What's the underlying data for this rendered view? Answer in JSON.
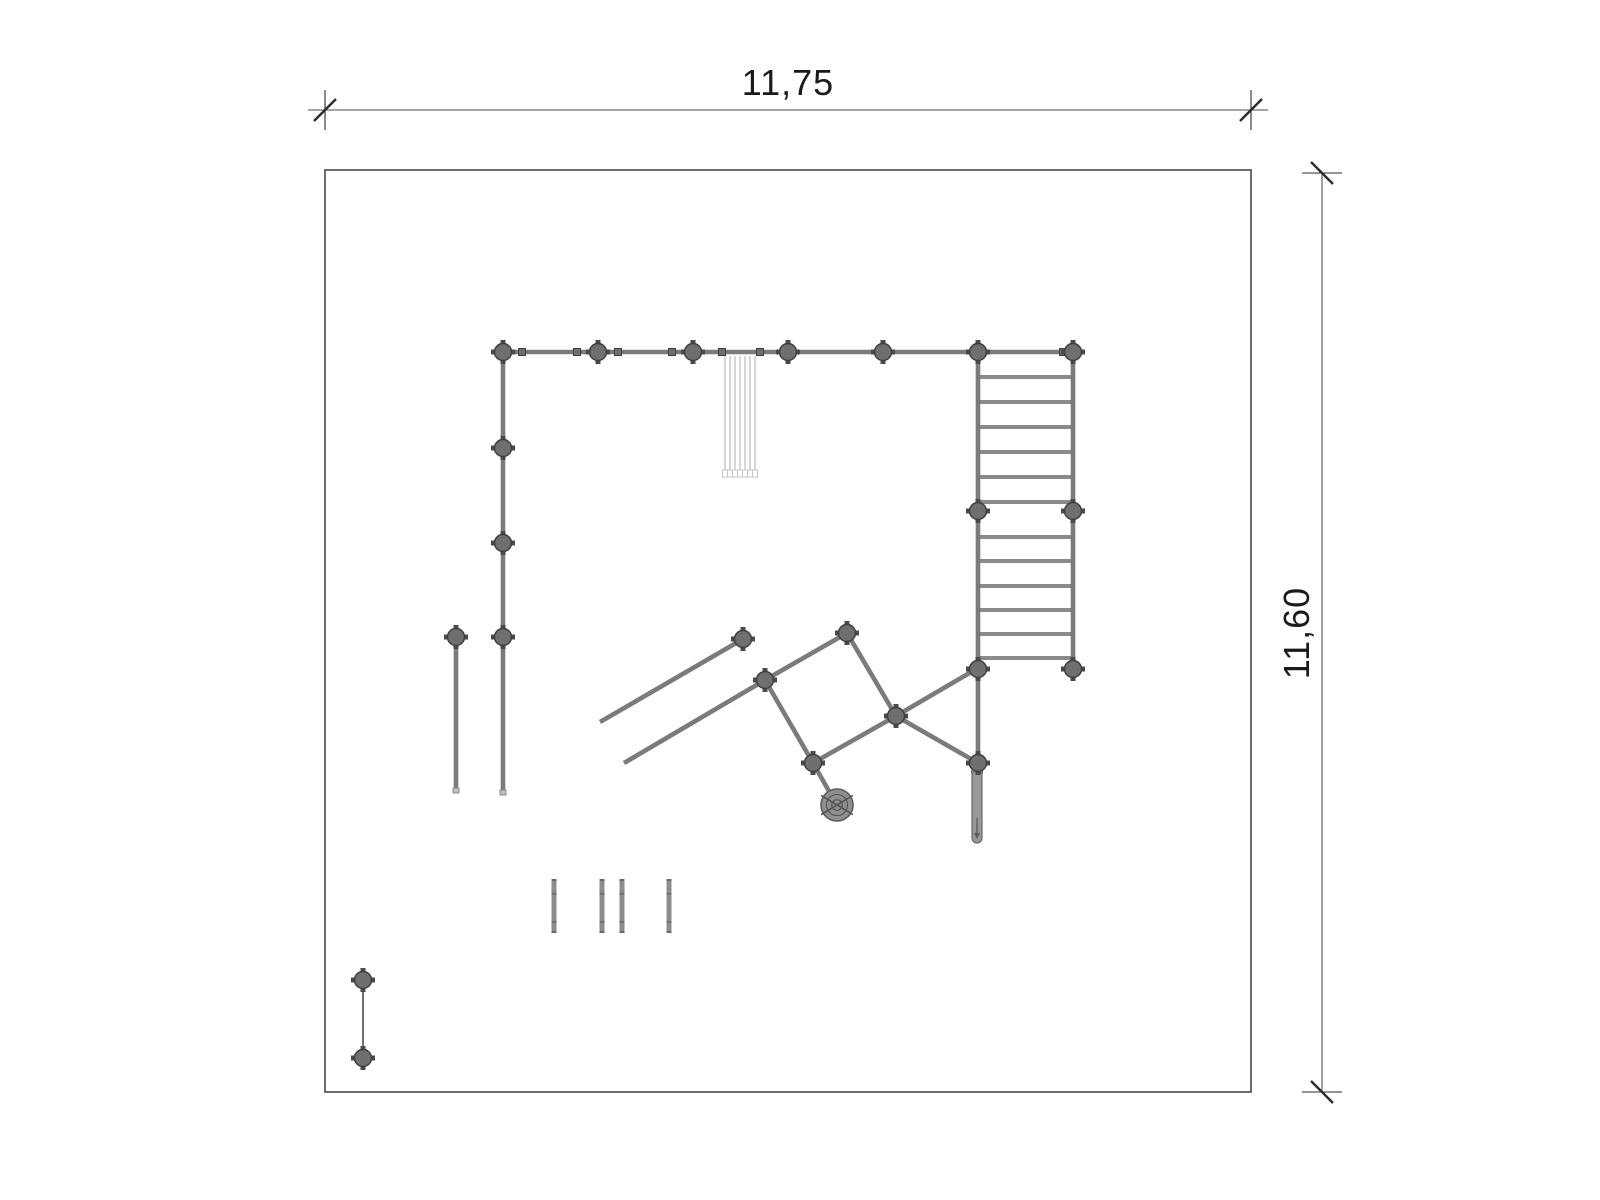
{
  "drawing": {
    "dim_top": {
      "label": "11,75",
      "line_y": 110,
      "x1": 308,
      "x2": 1268,
      "tick1": 325,
      "tick2": 1251,
      "label_cx": 788,
      "label_top": 62
    },
    "dim_right": {
      "label": "11,60",
      "line_x": 1322,
      "y1": 173,
      "y2": 1092,
      "label_cx": 1297,
      "label_cy": 633
    },
    "boundary": {
      "x": 325,
      "y": 170,
      "w": 926,
      "h": 922
    },
    "beams": [
      [
        503,
        352,
        1073,
        352
      ],
      [
        503,
        352,
        503,
        792
      ],
      [
        978,
        352,
        978,
        669
      ],
      [
        1073,
        352,
        1073,
        669
      ],
      [
        456,
        640,
        456,
        790
      ],
      [
        600,
        722,
        743,
        639
      ],
      [
        624,
        763,
        765,
        680
      ],
      [
        847,
        633,
        765,
        680
      ],
      [
        847,
        633,
        896,
        716
      ],
      [
        765,
        680,
        813,
        763
      ],
      [
        896,
        716,
        813,
        763
      ],
      [
        813,
        763,
        834,
        800
      ],
      [
        896,
        716,
        978,
        668
      ],
      [
        896,
        716,
        978,
        763
      ],
      [
        978,
        669,
        978,
        768
      ]
    ],
    "ladder_rungs": {
      "x1": 978,
      "x2": 1073,
      "ys": [
        377,
        402,
        427,
        452,
        477,
        502,
        537,
        561,
        586,
        610,
        634,
        658
      ]
    },
    "nodes": [
      [
        503,
        352
      ],
      [
        598,
        352
      ],
      [
        693,
        352
      ],
      [
        788,
        352
      ],
      [
        883,
        352
      ],
      [
        978,
        352
      ],
      [
        1073,
        352
      ],
      [
        503,
        448
      ],
      [
        503,
        543
      ],
      [
        503,
        637
      ],
      [
        978,
        511
      ],
      [
        1073,
        511
      ],
      [
        978,
        669
      ],
      [
        1073,
        669
      ],
      [
        847,
        633
      ],
      [
        765,
        680
      ],
      [
        896,
        716
      ],
      [
        813,
        763
      ],
      [
        743,
        639
      ],
      [
        978,
        763
      ],
      [
        456,
        637
      ],
      [
        363,
        980
      ],
      [
        363,
        1058
      ]
    ],
    "clamps": [
      [
        522,
        352
      ],
      [
        577,
        352
      ],
      [
        618,
        352
      ],
      [
        672,
        352
      ],
      [
        722,
        352
      ],
      [
        760,
        352
      ],
      [
        1063,
        352
      ]
    ],
    "hatch": {
      "x_start": 725,
      "count": 7,
      "step": 5,
      "y1": 356,
      "y2": 470,
      "foot_h": 7,
      "foot_w": 5
    },
    "short_bars": {
      "xs": [
        554,
        602,
        622,
        669
      ],
      "y1": 880,
      "y2": 932,
      "tick_ys": [
        893,
        921
      ]
    },
    "thin_links": [
      [
        363,
        988,
        363,
        1050
      ]
    ],
    "post_caps": [
      [
        503,
        790
      ],
      [
        456,
        788
      ]
    ],
    "spiral": {
      "cx": 837,
      "cy": 805,
      "r": 16
    },
    "pole": {
      "cx": 977,
      "y1": 770,
      "y2": 843,
      "w": 10
    },
    "colors": {
      "beam": "#7b7b7b",
      "node_fill": "#6f6f6f",
      "node_stroke": "#3e3e3e",
      "stub": "#4a4a4a",
      "rung": "#8a8a8a",
      "boundary": "#4a4a4a",
      "dim_line": "#6f6f6f",
      "dim_tick": "#2b2b2b",
      "hatch": "#c6c6c6",
      "bar": "#8d8d8d",
      "bar_tick": "#6a6a6a",
      "pole_fill": "#989898",
      "pole_stroke": "#6a6a6a",
      "pole_detail": "#5c5c5c",
      "spiral_fill": "#8f8f8f",
      "spiral_stroke": "#5d5d5d",
      "spiral_detail": "#4f4f4f",
      "thin": "#4c4c4c",
      "cap_fill": "#bfbfbf",
      "cap_stroke": "#8a8a8a"
    }
  }
}
